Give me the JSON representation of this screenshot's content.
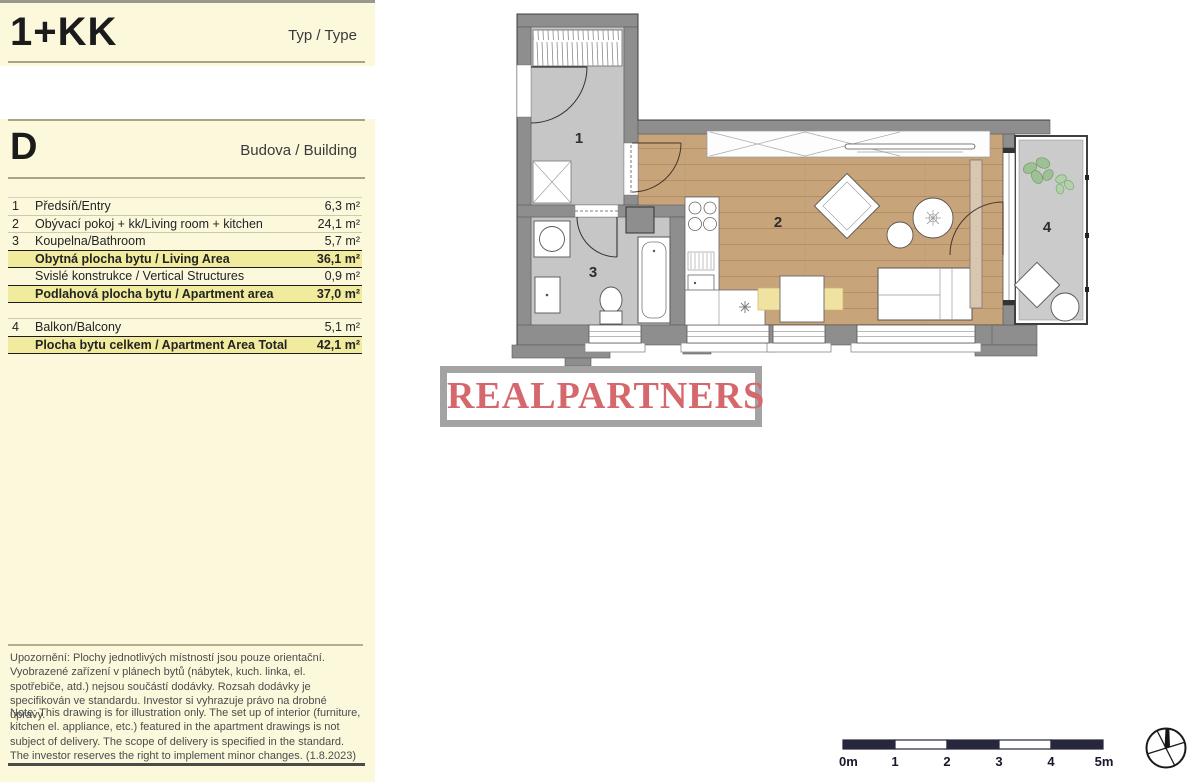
{
  "panel": {
    "type_code": "1+KK",
    "type_label": "Typ / Type",
    "building_code": "D",
    "building_label": "Budova / Building",
    "rows": [
      {
        "num": "1",
        "name": "Předsíň/Entry",
        "value": "6,3 m²"
      },
      {
        "num": "2",
        "name": "Obývací pokoj + kk/Living room + kitchen",
        "value": "24,1 m²"
      },
      {
        "num": "3",
        "name": "Koupelna/Bathroom",
        "value": "5,7 m²"
      },
      {
        "num": "",
        "name": "Obytná plocha bytu / Living Area",
        "value": "36,1 m²"
      },
      {
        "num": "",
        "name": "Svislé konstrukce / Vertical Structures",
        "value": "0,9 m²"
      },
      {
        "num": "",
        "name": "Podlahová plocha bytu / Apartment area",
        "value": "37,0 m²"
      },
      {
        "num": "4",
        "name": "Balkon/Balcony",
        "value": "5,1 m²"
      },
      {
        "num": "",
        "name": "Plocha bytu celkem / Apartment Area Total",
        "value": "42,1 m²"
      }
    ],
    "disclaimer_cs": "Upozornění: Plochy jednotlivých místností jsou pouze orientační. Vyobrazené zařízení  v plánech bytů (nábytek, kuch. linka, el. spotřebiče, atd.) nejsou součástí dodávky. Rozsah dodávky je specifikován ve standardu. Investor si vyhrazuje právo na drobné úpravy.",
    "disclaimer_en": "Note: This drawing is for illustration only. The set up of interior (furniture, kitchen el. appliance, etc.) featured in the apartment drawings is not subject of delivery. The scope of delivery is specified in the standard. The investor reserves the right to implement minor changes. (1.8.2023)"
  },
  "floorplan": {
    "room_labels": [
      "1",
      "2",
      "3",
      "4"
    ],
    "colors": {
      "wall": "#8e8e8e",
      "hard_floor": "#c6c6c6",
      "wood_floor": "#c8a47b",
      "balcony_floor": "#cbcbcb",
      "plant_green": "#9dc194"
    }
  },
  "logo": {
    "text": "REALPARTNERS",
    "color": "#d5686c"
  },
  "scalebar": {
    "labels": [
      "0m",
      "1",
      "2",
      "3",
      "4",
      "5m"
    ],
    "bar_color": "#26263c"
  },
  "compass": {
    "name": "north-arrow"
  }
}
